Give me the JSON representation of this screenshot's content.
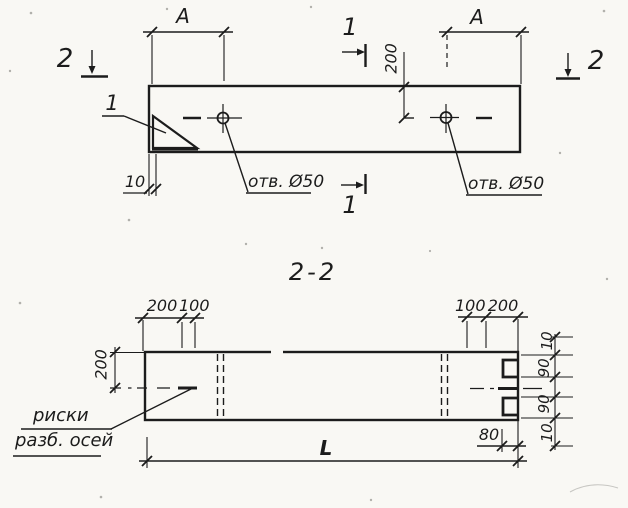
{
  "drawing": {
    "plan_view": {
      "section_label_left": "2",
      "section_label_right": "2",
      "cut_label_top": "1",
      "cut_label_bottom": "1",
      "corner_mark_callout": "1",
      "dim_hole_spacing_left": "A",
      "dim_hole_spacing_right": "A",
      "dim_hole_from_edge": "200",
      "dim_mark_from_end": "10",
      "hole_note_left": "отв. Ø50",
      "hole_note_right": "отв. Ø50"
    },
    "section_view": {
      "title": "2-2",
      "dim_top_left": [
        "200",
        "100"
      ],
      "dim_top_right": [
        "100",
        "200"
      ],
      "dim_side_left": "200",
      "dim_side_right": [
        "10",
        "90",
        "90",
        "10"
      ],
      "dim_end": "80",
      "dim_length": "L",
      "note_line1": "риски",
      "note_line2": "разб. осей"
    },
    "ink_color": "#1c1c1c",
    "paper_color": "#f9f8f4"
  }
}
